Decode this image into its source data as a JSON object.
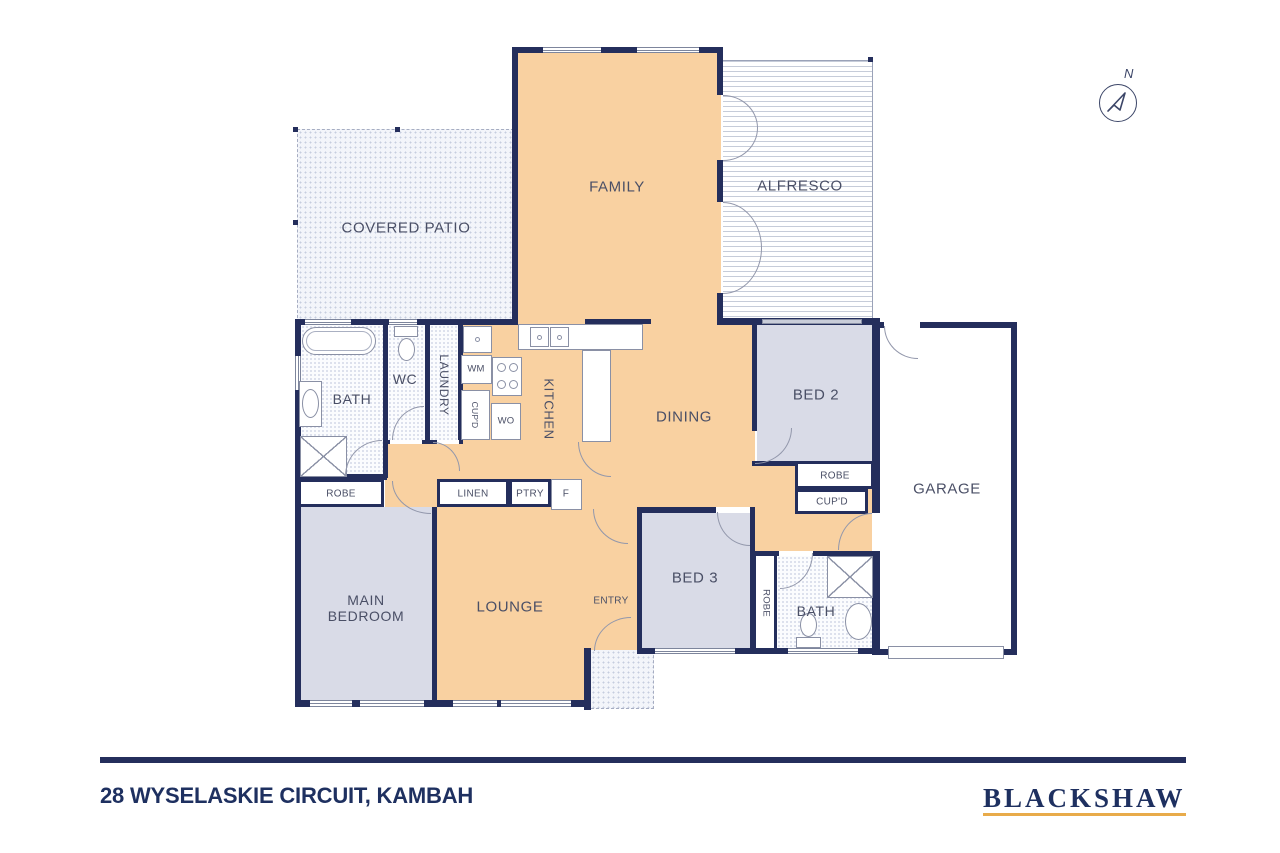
{
  "footer": {
    "address": "28 WYSELASKIE CIRCUIT, KAMBAH",
    "brand": "BLACKSHAW"
  },
  "compass": {
    "label": "N"
  },
  "rooms": {
    "covered_patio": "COVERED PATIO",
    "family": "FAMILY",
    "alfresco": "ALFRESCO",
    "bath1": "BATH",
    "wc": "WC",
    "laundry": "LAUNDRY",
    "kitchen": "KITCHEN",
    "dining": "DINING",
    "bed2": "BED 2",
    "garage": "GARAGE",
    "main_bedroom_line1": "MAIN",
    "main_bedroom_line2": "BEDROOM",
    "lounge": "LOUNGE",
    "entry": "ENTRY",
    "bed3": "BED 3",
    "bath2": "BATH"
  },
  "storage": {
    "robe_main": "ROBE",
    "linen": "LINEN",
    "ptry": "PTRY",
    "fridge": "F",
    "robe_bed2": "ROBE",
    "cupd_bed2": "CUP'D",
    "robe_bed3": "ROBE",
    "wm": "WM",
    "wo": "WO",
    "cupd_laundry": "CUP'D"
  },
  "colors": {
    "wall": "#242e5c",
    "living_fill": "#f9d1a1",
    "bedroom_fill": "#d9dbe7",
    "brand_navy": "#1e3060",
    "brand_gold": "#e8ab4a"
  }
}
